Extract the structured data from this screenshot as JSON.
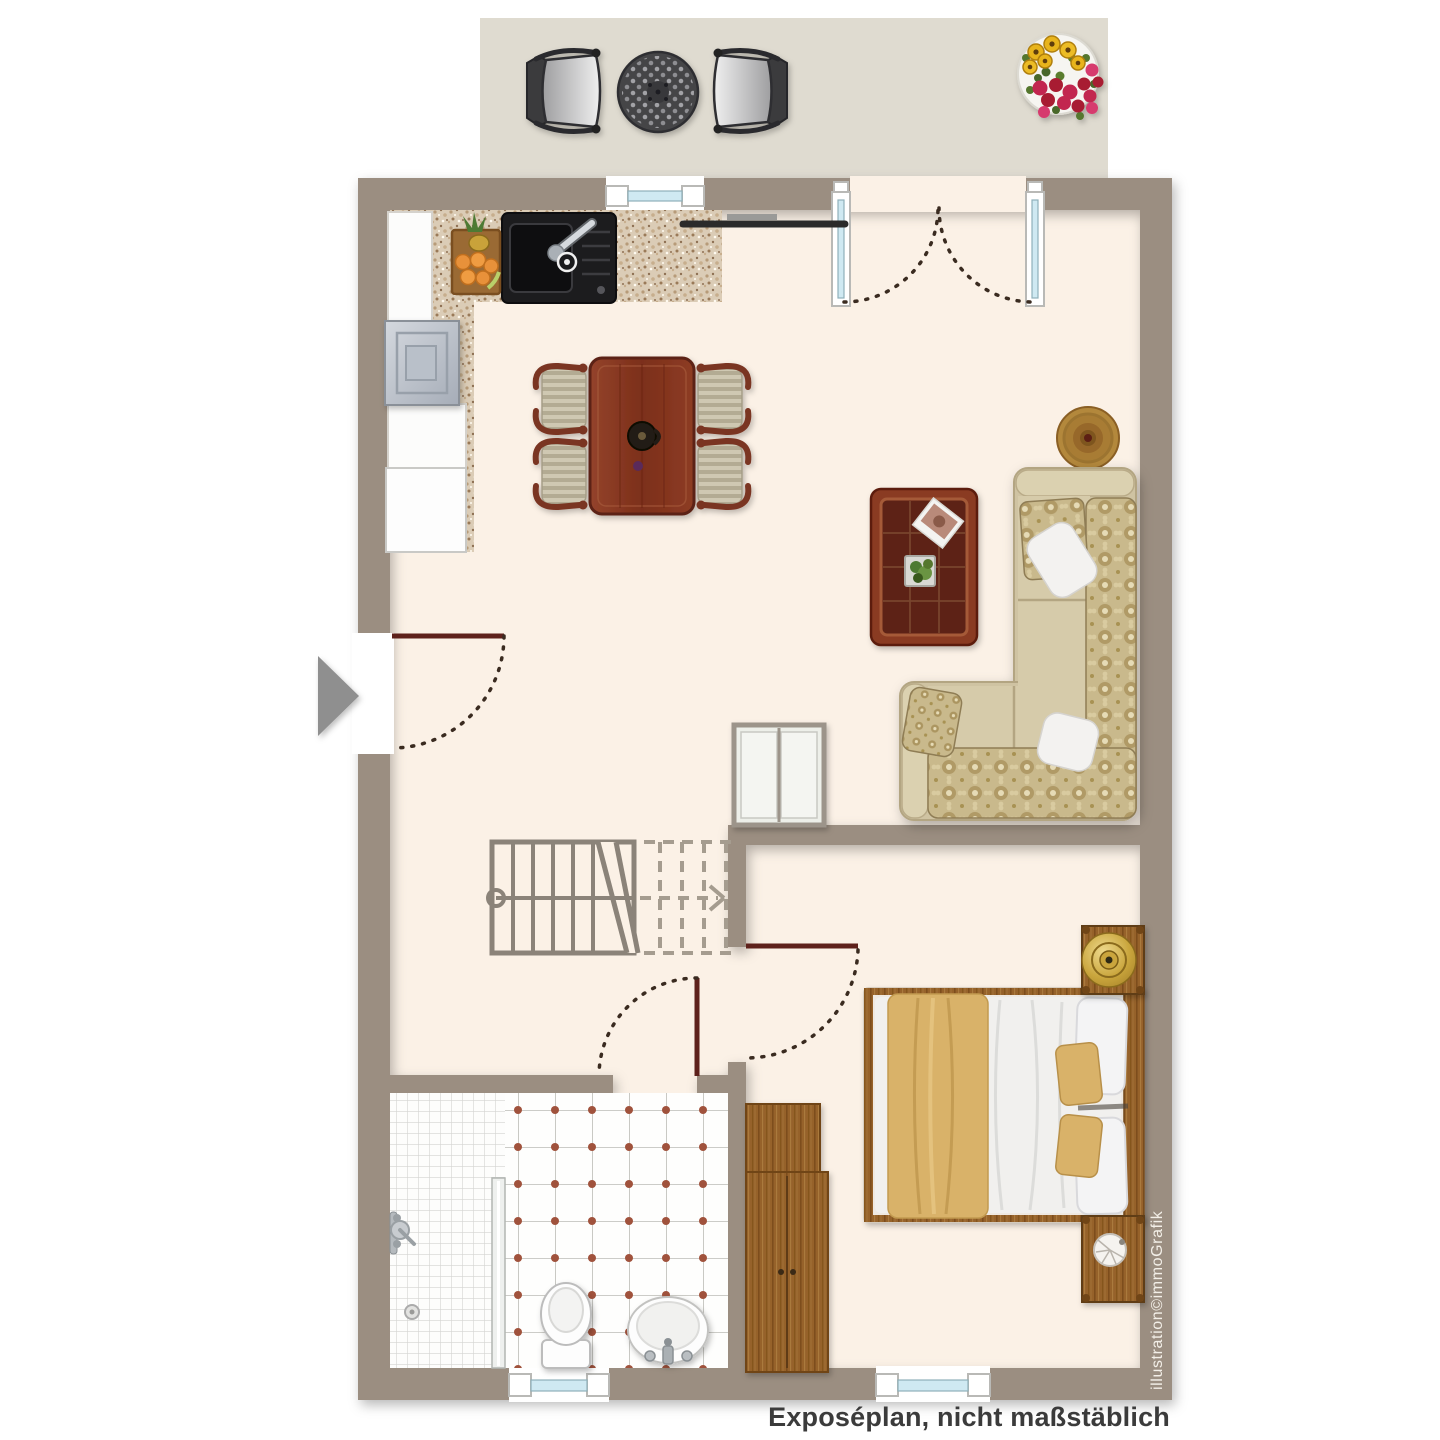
{
  "texts": {
    "caption": "Exposéplan, nicht maßstäblich",
    "watermark": "illustration©immoGrafik"
  },
  "palette": {
    "background": "#ffffff",
    "wall": "#9b8e81",
    "floor": "#fbf1e6",
    "terrace": "#dfdbd0",
    "door_leaf": "#5e211b",
    "window_glass": "#cfe9f2",
    "countertop": "#d9cab5",
    "dark_wood": "#8a3a24",
    "cabinet_wood": "#96622c",
    "sofa_beige": "#cfc3a2",
    "textile_tan": "#d9b269",
    "stair_grey": "#8b8379",
    "tile_dot": "#a0523c",
    "entry_arrow": "#8f8f8f"
  },
  "inventory": {
    "terrace": [
      "bistro-chair",
      "bistro-table",
      "bistro-chair",
      "flower-pot"
    ],
    "kitchen": [
      "kitchen-counter",
      "sink",
      "stove",
      "refrigerator",
      "fruit-basket"
    ],
    "living_dining": [
      "dining-table",
      "dining-chair",
      "dining-chair",
      "dining-chair",
      "dining-chair",
      "tv",
      "corner-sofa",
      "coffee-table",
      "round-rug",
      "hall-closet",
      "staircase",
      "entry-arrow"
    ],
    "bedroom": [
      "double-bed",
      "nightstand-with-lamp",
      "nightstand-with-lamp",
      "wardrobe"
    ],
    "bathroom": [
      "shower",
      "glass-partition",
      "toilet",
      "wash-basin"
    ]
  }
}
